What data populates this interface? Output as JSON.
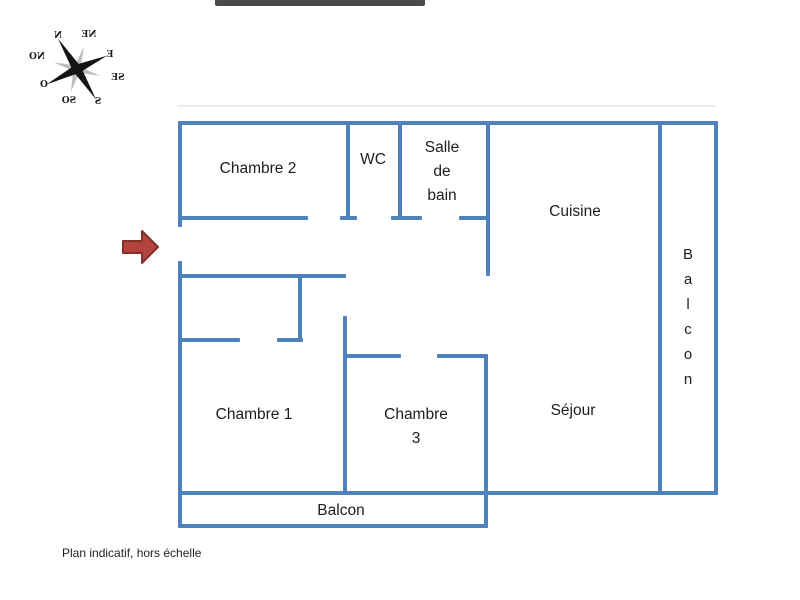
{
  "plan": {
    "footnote": "Plan indicatif, hors échelle",
    "rooms": {
      "chambre2": {
        "label": "Chambre 2"
      },
      "wc": {
        "label": "WC"
      },
      "salle_de_bain": {
        "label": "Salle de bain"
      },
      "cuisine": {
        "label": "Cuisine"
      },
      "balcon_right": {
        "label": "Balcon"
      },
      "chambre1": {
        "label": "Chambre 1"
      },
      "chambre3": {
        "label": "Chambre 3"
      },
      "sejour": {
        "label": "Séjour"
      },
      "balcon_bottom": {
        "label": "Balcon"
      }
    }
  },
  "compass": {
    "labels": {
      "n": "N",
      "ne": "NE",
      "e": "E",
      "se": "SE",
      "s": "S",
      "so": "SO",
      "o": "O",
      "no": "NO"
    },
    "note": "compass rose rendered mirrored and rotated as in source image"
  },
  "entrance": {
    "description": "entrance arrow pointing right into door gap of left wall"
  },
  "colors": {
    "wall": "#4f81bd",
    "arrow_fill": "#b2433e",
    "arrow_stroke": "#84302b",
    "text": "#1d1d1d",
    "top_bar": "#4a4a4a",
    "compass_dark": "#141414",
    "compass_gray": "#b3b3b3"
  }
}
